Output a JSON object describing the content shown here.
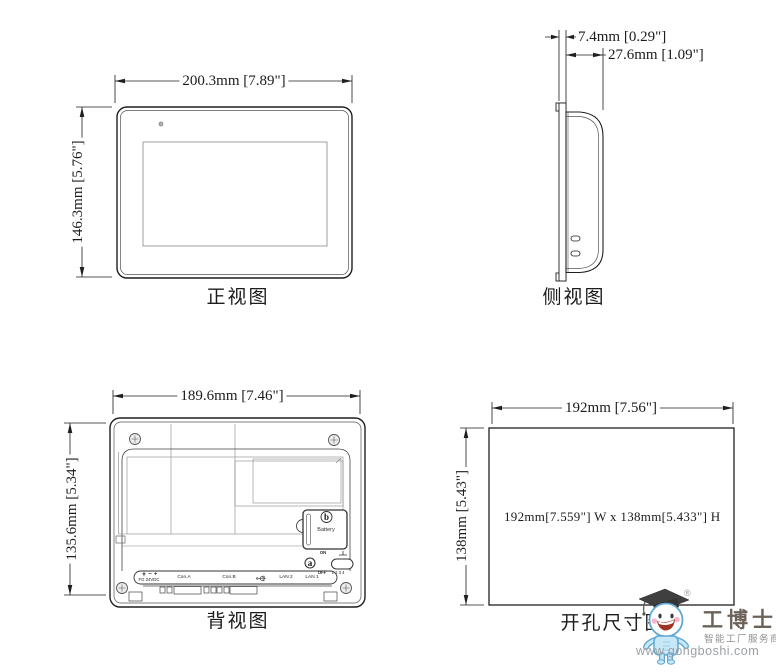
{
  "page": {
    "background": "#ffffff",
    "line_color": "#1f1f1f"
  },
  "views": {
    "front": {
      "title": "正视图",
      "width_dim": "200.3mm [7.89\"]",
      "height_dim": "146.3mm [5.76\"]"
    },
    "side": {
      "title": "侧视图",
      "bezel_depth_dim": "7.4mm [0.29\"]",
      "total_depth_dim": "27.6mm [1.09\"]"
    },
    "back": {
      "title": "背视图",
      "width_dim": "189.6mm [7.46\"]",
      "height_dim": "135.6mm [5.34\"]",
      "battery": {
        "key": "b",
        "label": "Battery"
      },
      "dip_switch": {
        "key": "a",
        "on": "ON",
        "off": "OFF",
        "numbers": "1 2 3 4"
      },
      "terminal": {
        "symbols_icon": "ground-minus-plus-icons",
        "label": "FG 24VDC"
      },
      "ports": [
        {
          "label": "Con.A"
        },
        {
          "label": "Con.B"
        },
        {
          "label": "LAN 2"
        },
        {
          "label": "LAN 1"
        }
      ],
      "usb_icon": "usb-trident-icon"
    },
    "cutout": {
      "title": "开孔尺寸图",
      "width_dim": "192mm [7.56\"]",
      "height_dim": "138mm [5.43\"]",
      "size_note": "192mm[7.559\"] W x 138mm[5.433\"] H"
    }
  },
  "logo": {
    "brand": "工博士",
    "registered": "®",
    "tagline": "智能工厂服务商",
    "url": "www.gongboshi.com",
    "mascot_icon": "graduate-mascot-icon",
    "mascot_color": "#c9e8f7",
    "brand_color": "#6b635a"
  }
}
